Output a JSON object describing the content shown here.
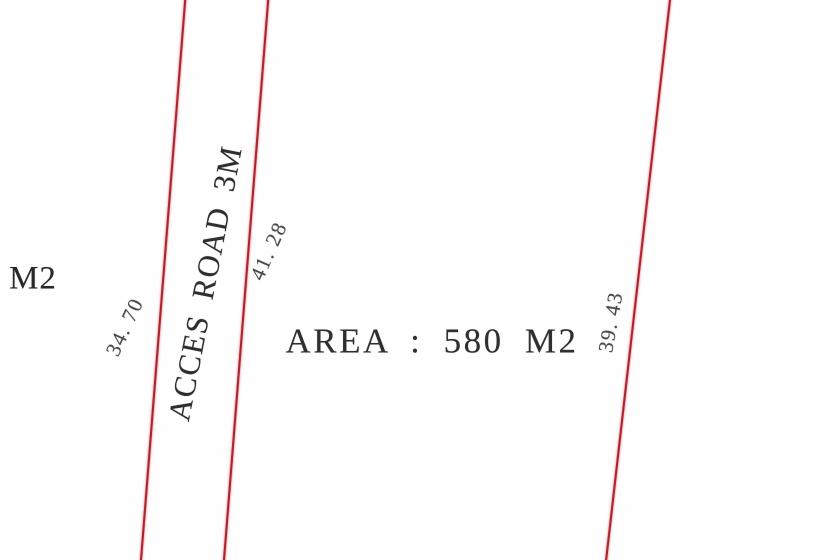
{
  "diagram": {
    "description": "Land survey plot plan",
    "background_color": "#fefefe",
    "line_color": "#ad2330",
    "text_color": "#333333",
    "area_label": "AREA : 580 M2",
    "road_label": "ACCES ROAD 3M",
    "road_width_m": "3M",
    "area_value_m2": "580",
    "lines": [
      {
        "name": "access-road-west-boundary",
        "x1": 185,
        "y1": -5,
        "x2": 140,
        "y2": 565
      },
      {
        "name": "access-road-east-boundary",
        "x1": 268,
        "y1": -5,
        "x2": 223,
        "y2": 565
      },
      {
        "name": "parcel-east-boundary",
        "x1": 670,
        "y1": -5,
        "x2": 605,
        "y2": 565
      }
    ],
    "labels": {
      "neighbor_m2": {
        "text": "M2",
        "x": 33,
        "y": 279,
        "size": 33,
        "rotate": 0
      },
      "dim_34_70": {
        "text": "34. 70",
        "x": 125,
        "y": 327,
        "size": 21,
        "rotate": -65
      },
      "acces_road": {
        "text": "ACCES ROAD 3M",
        "x": 205,
        "y": 283,
        "size": 31,
        "rotate": -79
      },
      "dim_41_28": {
        "text": "41. 28",
        "x": 269,
        "y": 251,
        "size": 21,
        "rotate": -66
      },
      "area": {
        "text": "AREA : 580 M2",
        "x": 432,
        "y": 341,
        "size": 35,
        "rotate": 0
      },
      "dim_39_43": {
        "text": "39. 43",
        "x": 611,
        "y": 322,
        "size": 21,
        "rotate": -80
      }
    }
  }
}
